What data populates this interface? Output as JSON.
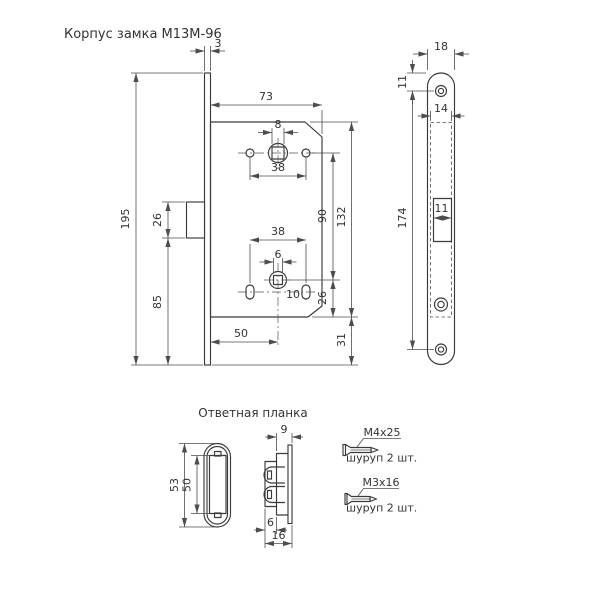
{
  "title": "Корпус замка М13М-96",
  "main_view": {
    "faceplate_thickness": "3",
    "case_width": "73",
    "plate_height": "195",
    "latch_height": "26",
    "latch_to_plate_bottom": "85",
    "spindle_square": "8",
    "handle_holes_spacing": "38",
    "spindle_to_wc": "90",
    "case_height": "132",
    "wc_to_case_bottom": "26",
    "case_to_plate_bottom": "31",
    "bottom_holes_spacing": "38",
    "wc_square": "6",
    "slot_width": "10",
    "backset": "50"
  },
  "faceplate_view": {
    "plate_width": "18",
    "top_hole_offset": "11",
    "inner_width": "14",
    "holes_spacing": "174",
    "latch_opening_width": "11"
  },
  "strike_plate": {
    "title": "Ответная планка",
    "outer_height": "53",
    "inner_height": "50",
    "flange_depth": "9",
    "tab_offset": "6",
    "total_depth": "16"
  },
  "screws": [
    {
      "label": "М4х25",
      "qty": "шуруп 2 шт."
    },
    {
      "label": "М3х16",
      "qty": "шуруп 2 шт."
    }
  ]
}
